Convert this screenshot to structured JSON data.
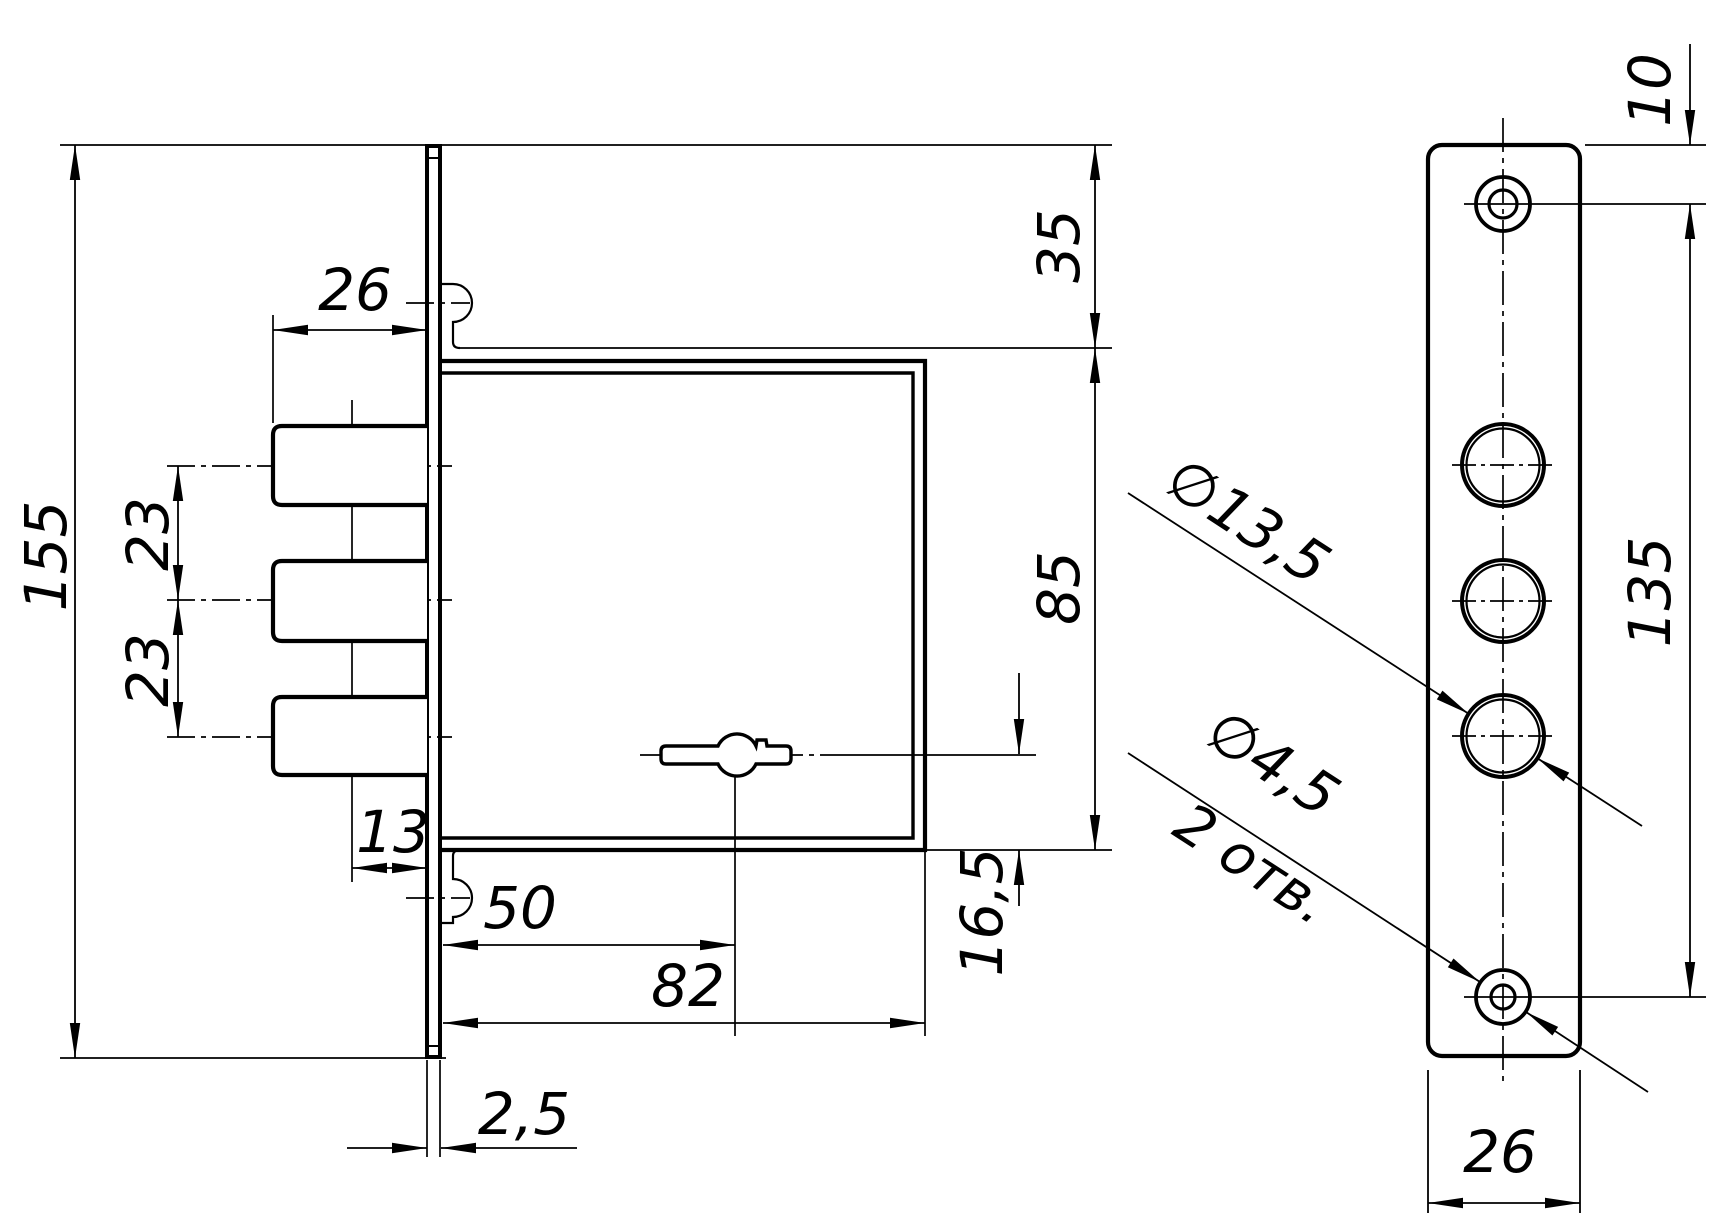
{
  "drawing": {
    "kind": "technical-drawing",
    "subject": "mortise deadbolt lock, side view and faceplate front view",
    "colors": {
      "line": "#000000",
      "background": "#ffffff"
    },
    "views": {
      "side_view": "lock case with faceplate, three bolts and keyhole",
      "front_view": "faceplate with three bolt holes and two screw holes"
    }
  },
  "dims": {
    "overall_height": "155",
    "bolt_extension": "26",
    "bolt_pitch_upper": "23",
    "bolt_pitch_lower": "23",
    "bolt_line_offset": "13",
    "keyhole_backset": "50",
    "case_depth": "82",
    "faceplate_thickness": "2,5",
    "case_top_offset": "35",
    "case_height": "85",
    "keyhole_bottom_offset": "16,5",
    "screw_top_offset": "10",
    "screw_pitch": "135",
    "faceplate_width": "26",
    "bolt_hole_diameter": "∅13,5",
    "screw_hole_diameter": "∅4,5",
    "screw_hole_quantity": "2 отв."
  }
}
